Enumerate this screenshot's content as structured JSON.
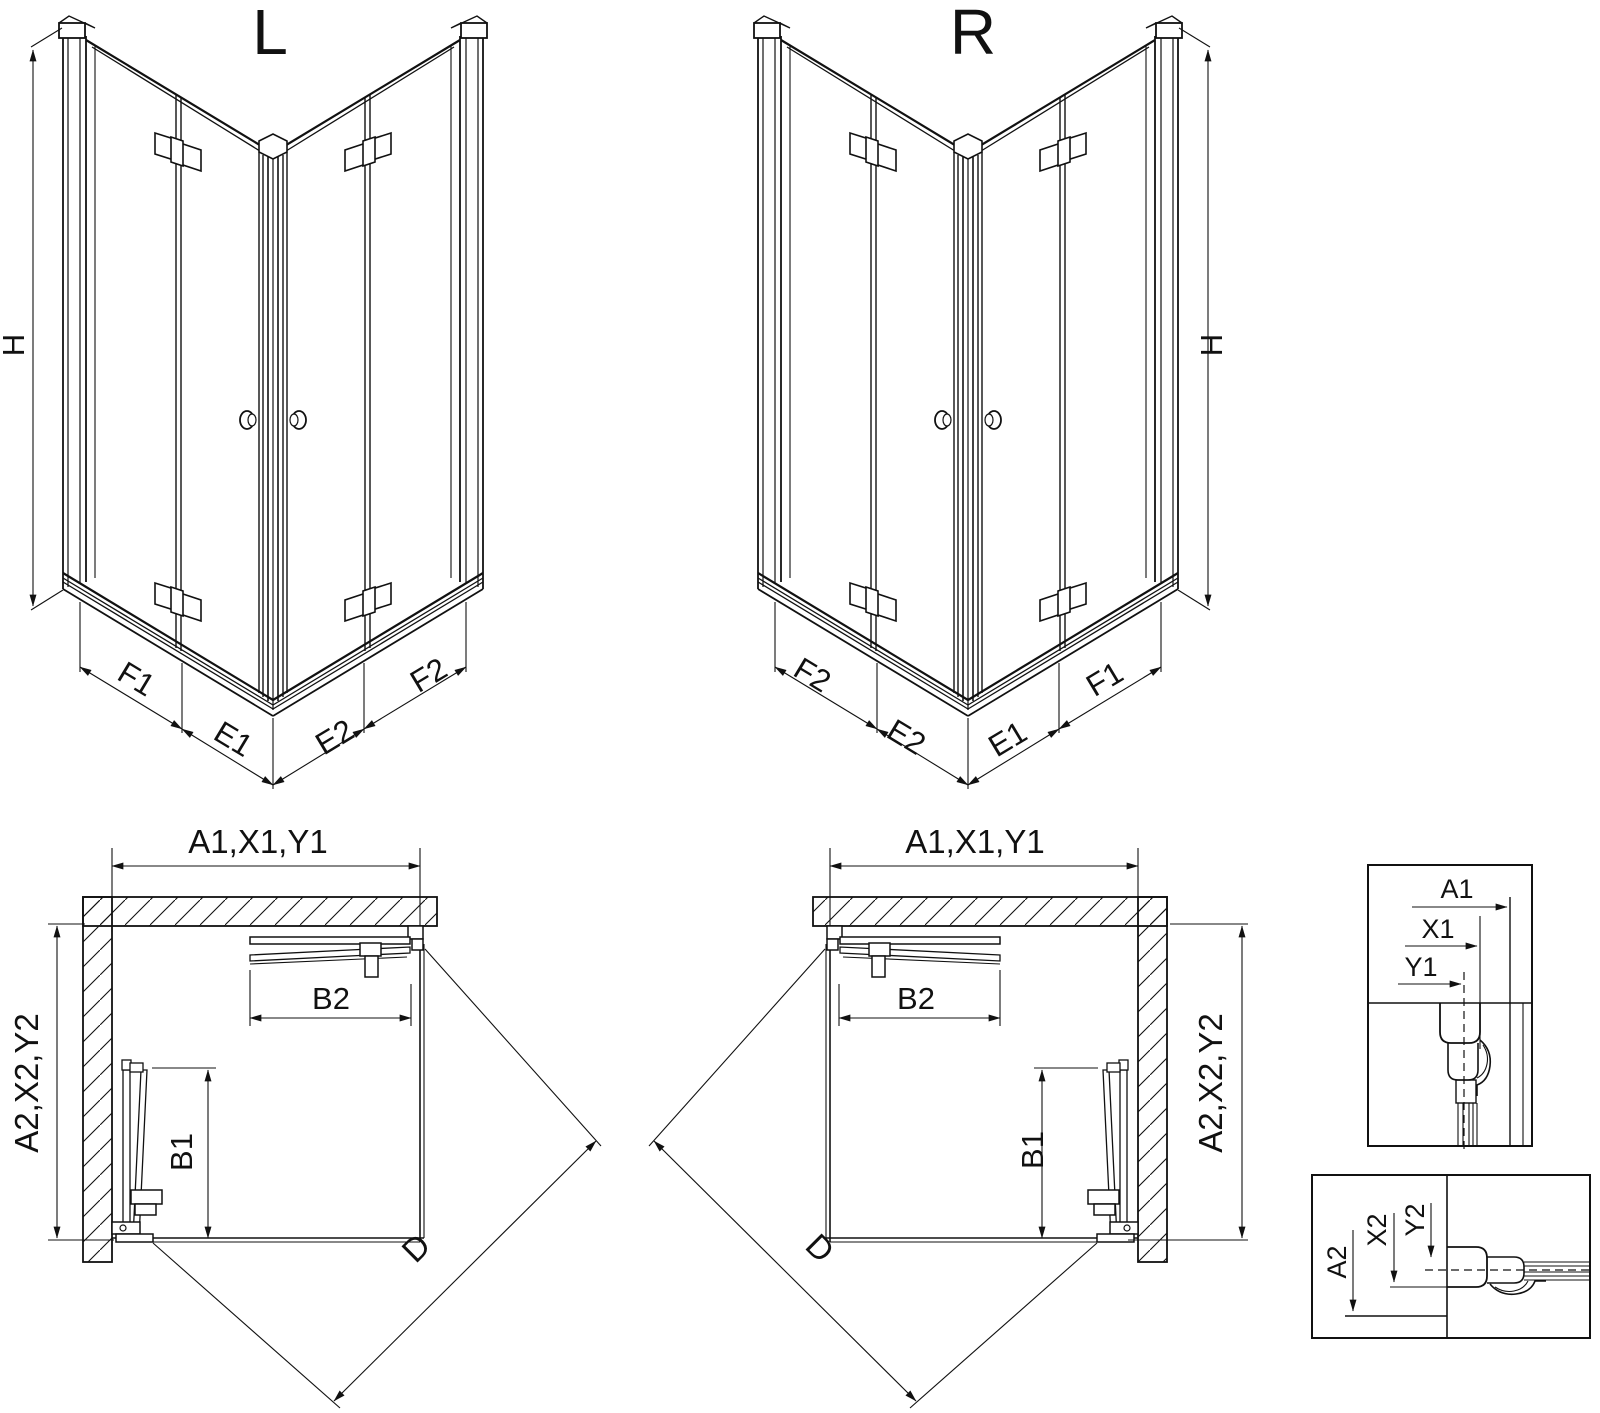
{
  "drawing": {
    "type": "shower-enclosure-technical-diagram",
    "background_color": "#ffffff",
    "line_color": "#111111",
    "views": {
      "iso_left": {
        "title": "L",
        "height_dim": "H",
        "bottom_dims": [
          "F1",
          "E1",
          "E2",
          "F2"
        ]
      },
      "iso_right": {
        "title": "R",
        "height_dim": "H",
        "bottom_dims": [
          "F2",
          "E2",
          "E1",
          "F1"
        ]
      },
      "plan_left": {
        "width_dim": "A1,X1,Y1",
        "depth_dim": "A2,X2,Y2",
        "door_top_dim": "B2",
        "door_side_dim": "B1",
        "diagonal_dim": "D"
      },
      "plan_right": {
        "width_dim": "A1,X1,Y1",
        "depth_dim": "A2,X2,Y2",
        "door_top_dim": "B2",
        "door_side_dim": "B1",
        "diagonal_dim": "D"
      },
      "detail_top": {
        "dims": [
          "A1",
          "X1",
          "Y1"
        ]
      },
      "detail_bottom": {
        "dims": [
          "A2",
          "X2",
          "Y2"
        ]
      }
    }
  }
}
